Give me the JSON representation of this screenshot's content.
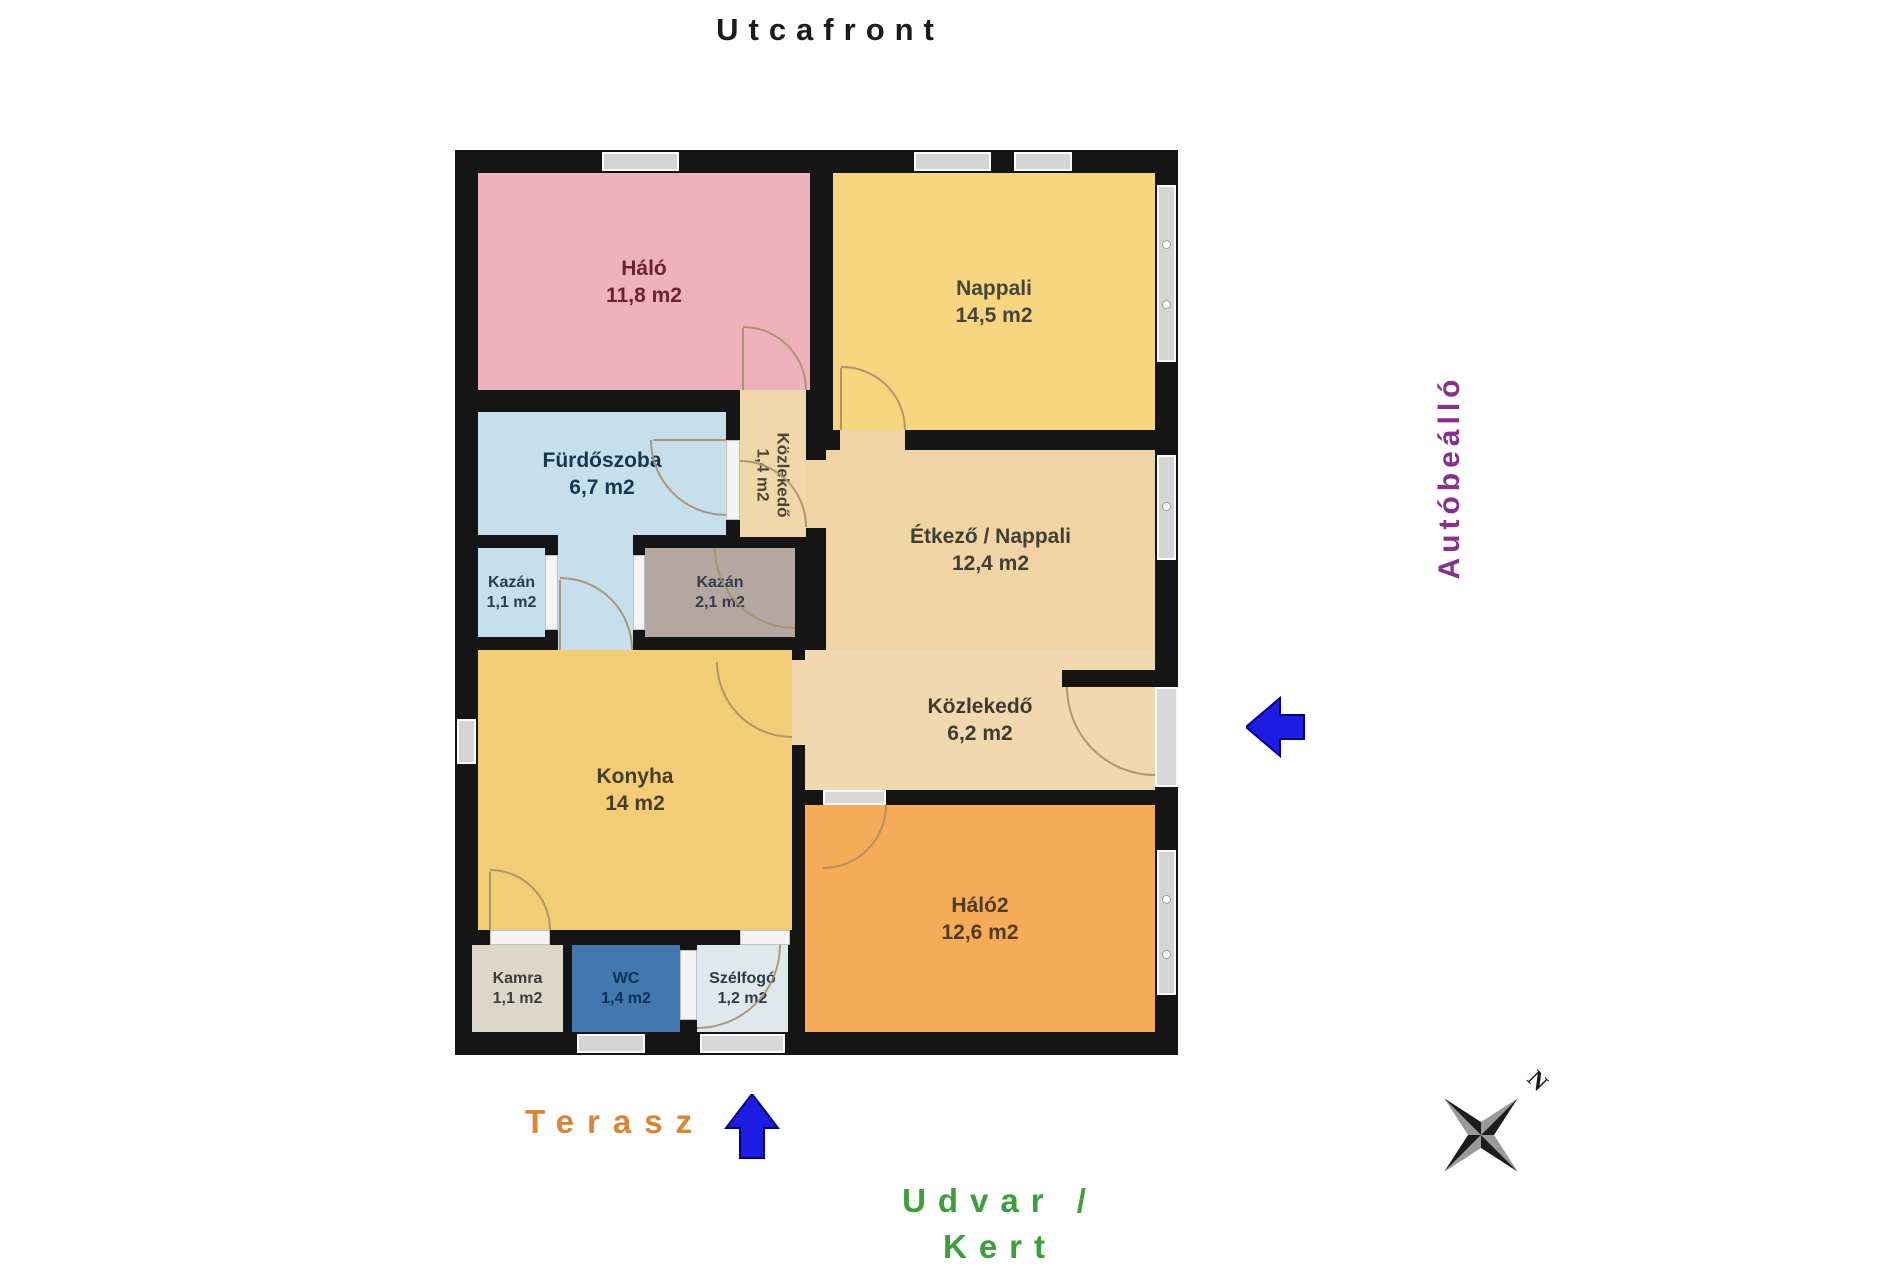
{
  "labels": {
    "street_front": "Utcafront",
    "carport": "Autóbeálló",
    "terrace": "Terasz",
    "yard_line1": "Udvar /",
    "yard_line2": "Kert",
    "compass_north": "N"
  },
  "colors": {
    "wall": "#151515",
    "arrow_blue": "#1c1ce2",
    "street_front_text": "#1b1b1b",
    "carport_text": "#8b2e8f",
    "terrace_text": "#dd8430",
    "yard_text": "#3ba03b",
    "window": "#d5d5d5"
  },
  "rooms": {
    "halo": {
      "name": "Háló",
      "area": "11,8 m2",
      "color": "#efb2bd"
    },
    "nappali": {
      "name": "Nappali",
      "area": "14,5 m2",
      "color": "#f7d67f"
    },
    "furdoszoba": {
      "name": "Fürdőszoba",
      "area": "6,7 m2",
      "color": "#c7deed"
    },
    "kozlekedo_kis": {
      "name": "Közlekedő",
      "area": "1,4 m2",
      "color": "#f1d8ab"
    },
    "kazan_kis": {
      "name": "Kazán",
      "area": "1,1 m2",
      "color": "#c7deed"
    },
    "kazan_nagy": {
      "name": "Kazán",
      "area": "2,1 m2",
      "color": "#b3a7a0"
    },
    "etkezo_nappali": {
      "name": "Étkező / Nappali",
      "area": "12,4 m2",
      "color": "#f0d4a6"
    },
    "konyha": {
      "name": "Konyha",
      "area": "14 m2",
      "color": "#f3cd75"
    },
    "kozlekedo": {
      "name": "Közlekedő",
      "area": "6,2 m2",
      "color": "#f1d8ae"
    },
    "halo2": {
      "name": "Háló2",
      "area": "12,6 m2",
      "color": "#f6ab57"
    },
    "kamra": {
      "name": "Kamra",
      "area": "1,1 m2",
      "color": "#dbd7cb"
    },
    "wc": {
      "name": "WC",
      "area": "1,4 m2",
      "color": "#4278ad"
    },
    "szelfogo": {
      "name": "Szélfogó",
      "area": "1,2 m2",
      "color": "#dfe9ec"
    }
  }
}
